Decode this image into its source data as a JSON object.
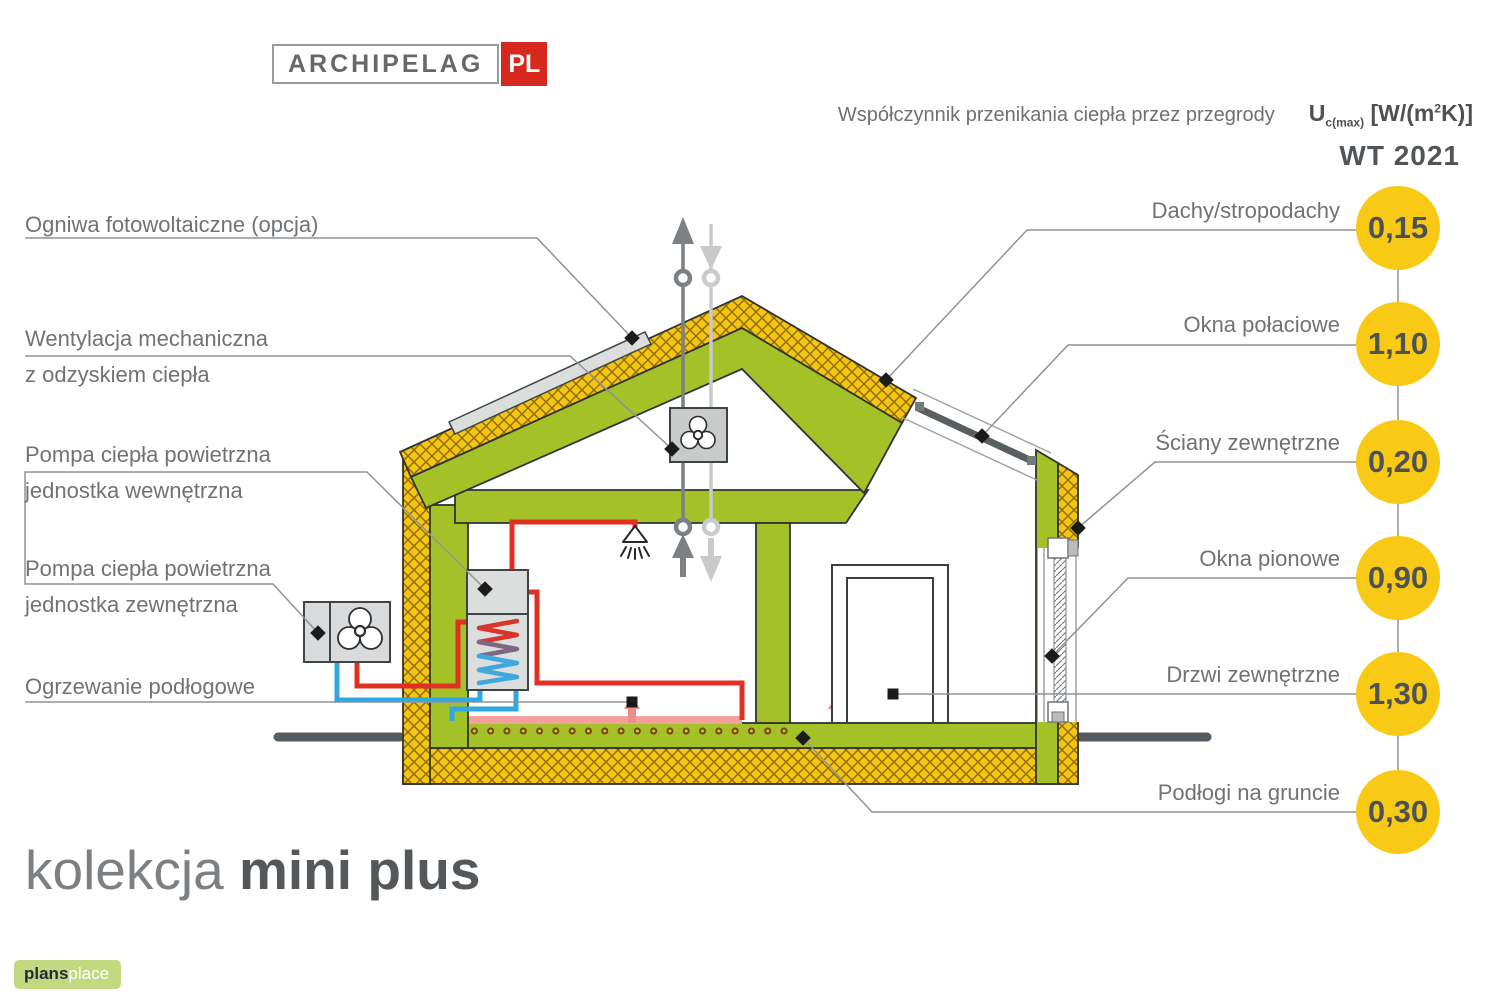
{
  "brand": {
    "name": "ARCHIPELAG",
    "suffix": "PL"
  },
  "header": {
    "subtitle": "Współczynnik przenikania ciepła przez przegrody",
    "coefficient": {
      "symbol": "U",
      "subscript": "c(max)",
      "unit_open": " [W/(m",
      "exponent": "2",
      "unit_close": "K)]"
    },
    "standard": "WT 2021"
  },
  "annotations_left": [
    {
      "line1": "Ogniwa fotowoltaiczne (opcja)",
      "line2": ""
    },
    {
      "line1": "Wentylacja mechaniczna",
      "line2": "z odzyskiem ciepła"
    },
    {
      "line1": "Pompa ciepła powietrzna",
      "line2": "jednostka wewnętrzna"
    },
    {
      "line1": "Pompa ciepła powietrzna",
      "line2": "jednostka zewnętrzna"
    },
    {
      "line1": "Ogrzewanie podłogowe",
      "line2": ""
    }
  ],
  "u_values": [
    {
      "label": "Dachy/stropodachy",
      "value": "0,15"
    },
    {
      "label": "Okna połaciowe",
      "value": "1,10"
    },
    {
      "label": "Ściany zewnętrzne",
      "value": "0,20"
    },
    {
      "label": "Okna pionowe",
      "value": "0,90"
    },
    {
      "label": "Drzwi zewnętrzne",
      "value": "1,30"
    },
    {
      "label": "Podłogi na gruncie",
      "value": "0,30"
    }
  ],
  "collection": {
    "prefix": "kolekcja",
    "name": "mini plus"
  },
  "footer_logo": {
    "bold": "plans",
    "light": "place"
  },
  "colors": {
    "accent_yellow": "#f8ca15",
    "wall_green": "#a4c227",
    "insulation_yellow": "#f6c513",
    "pipe_red": "#e03024",
    "pipe_blue": "#2fa8e1",
    "brand_red": "#d7281e",
    "logo_green": "#c3d97f"
  }
}
